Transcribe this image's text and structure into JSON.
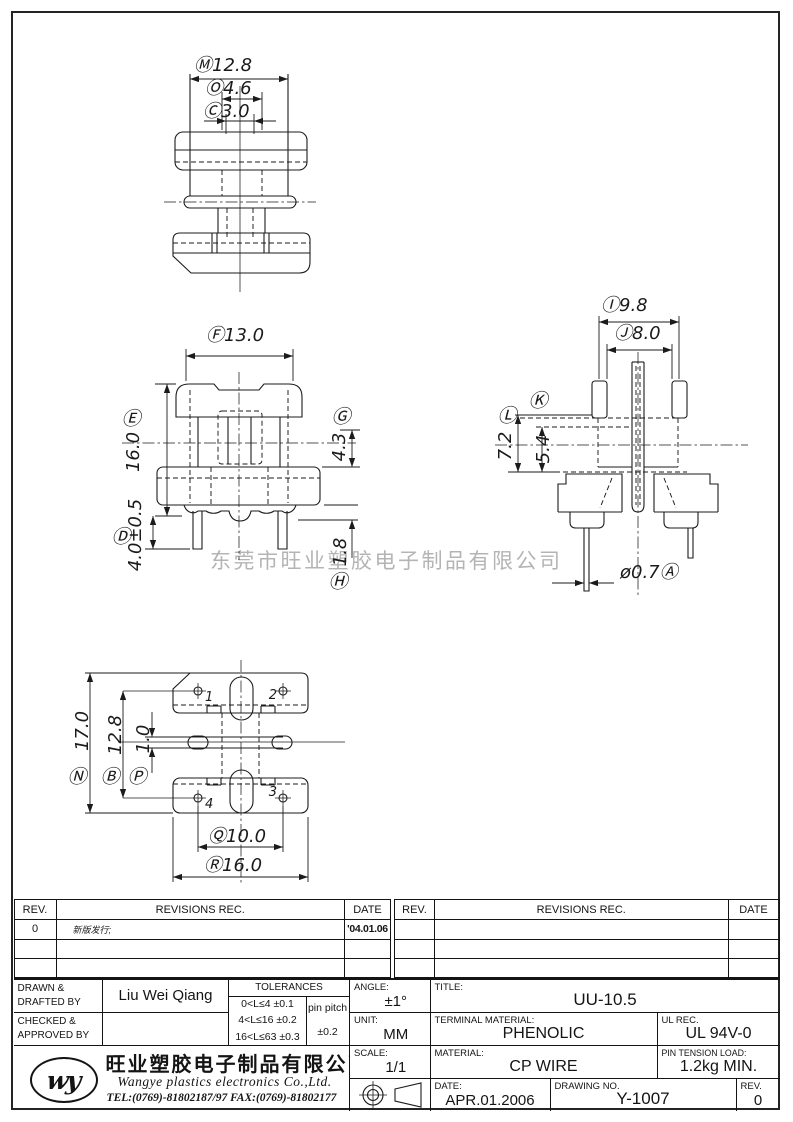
{
  "watermark": "东莞市旺业塑胶电子制品有限公司",
  "dims": {
    "top": {
      "m": "Ⓜ12.8",
      "o": "Ⓞ4.6",
      "c": "Ⓒ3.0"
    },
    "front": {
      "f": "Ⓕ13.0",
      "e_letter": "Ⓔ",
      "e_value": "16.0",
      "d_letter": "Ⓓ",
      "d_value": "4.0±0.5",
      "g_letter": "Ⓖ",
      "g_value": "4.3",
      "h_letter": "Ⓗ",
      "h_value": "1.8"
    },
    "side": {
      "i": "Ⓘ9.8",
      "j": "Ⓙ8.0",
      "k_letter": "Ⓚ",
      "k_value": "5.4",
      "l_letter": "Ⓛ",
      "l_value": "7.2",
      "a": "ø0.7Ⓐ"
    },
    "bottom": {
      "n_letter": "Ⓝ",
      "n_value": "17.0",
      "b_letter": "Ⓑ",
      "b_value": "12.8",
      "p_letter": "Ⓟ",
      "p_value": "1.0",
      "q": "Ⓠ10.0",
      "r": "Ⓡ16.0",
      "pin1": "1",
      "pin2": "2",
      "pin3": "3",
      "pin4": "4"
    }
  },
  "revisions": {
    "left": {
      "headers": {
        "rev": "REV.",
        "revisions": "REVISIONS   REC.",
        "date": "DATE"
      },
      "rows": [
        {
          "rev": "0",
          "desc": "新版发行;",
          "date": "'04.01.06"
        },
        {
          "rev": "",
          "desc": "",
          "date": ""
        },
        {
          "rev": "",
          "desc": "",
          "date": ""
        }
      ]
    },
    "right": {
      "headers": {
        "rev": "REV.",
        "revisions": "REVISIONS   REC.",
        "date": "DATE"
      },
      "rows": [
        {
          "rev": "",
          "desc": "",
          "date": ""
        },
        {
          "rev": "",
          "desc": "",
          "date": ""
        },
        {
          "rev": "",
          "desc": "",
          "date": ""
        }
      ]
    }
  },
  "title_block": {
    "drawn_label_1": "DRAWN &",
    "drawn_label_2": "DRAFTED BY",
    "drawn_by": "Liu Wei Qiang",
    "checked_label_1": "CHECKED &",
    "checked_label_2": "APPROVED BY",
    "checked_by": "",
    "tolerances": {
      "title": "TOLERANCES",
      "rows": [
        "0<L≤4   ±0.1",
        "4<L≤16  ±0.2",
        "16<L≤63 ±0.3"
      ],
      "pin_pitch_label": "pin pitch",
      "pin_pitch_value": "±0.2"
    },
    "angle": {
      "label": "ANGLE:",
      "value": "±1°"
    },
    "unit": {
      "label": "UNIT:",
      "value": "MM"
    },
    "scale": {
      "label": "SCALE:",
      "value": "1/1"
    },
    "title": {
      "label": "TITLE:",
      "value": "UU-10.5"
    },
    "terminal": {
      "label": "TERMINAL MATERIAL:",
      "value": "PHENOLIC"
    },
    "ul": {
      "label": "UL REC.",
      "value": "UL 94V-0"
    },
    "material": {
      "label": "MATERIAL:",
      "value": "CP WIRE"
    },
    "pin_tension": {
      "label": "PIN TENSION LOAD:",
      "value": "1.2kg MIN."
    },
    "date": {
      "label": "DATE:",
      "value": "APR.01.2006"
    },
    "drawing_no": {
      "label": "DRAWING NO.",
      "value": "Y-1007"
    },
    "rev": {
      "label": "REV.",
      "value": "0"
    }
  },
  "company": {
    "logo": "wy",
    "name_cn": "旺业塑胶电子制品有限公司",
    "name_en": "Wangye plastics electronics Co.,Ltd.",
    "tel": "TEL:(0769)-81802187/97   FAX:(0769)-81802177"
  }
}
